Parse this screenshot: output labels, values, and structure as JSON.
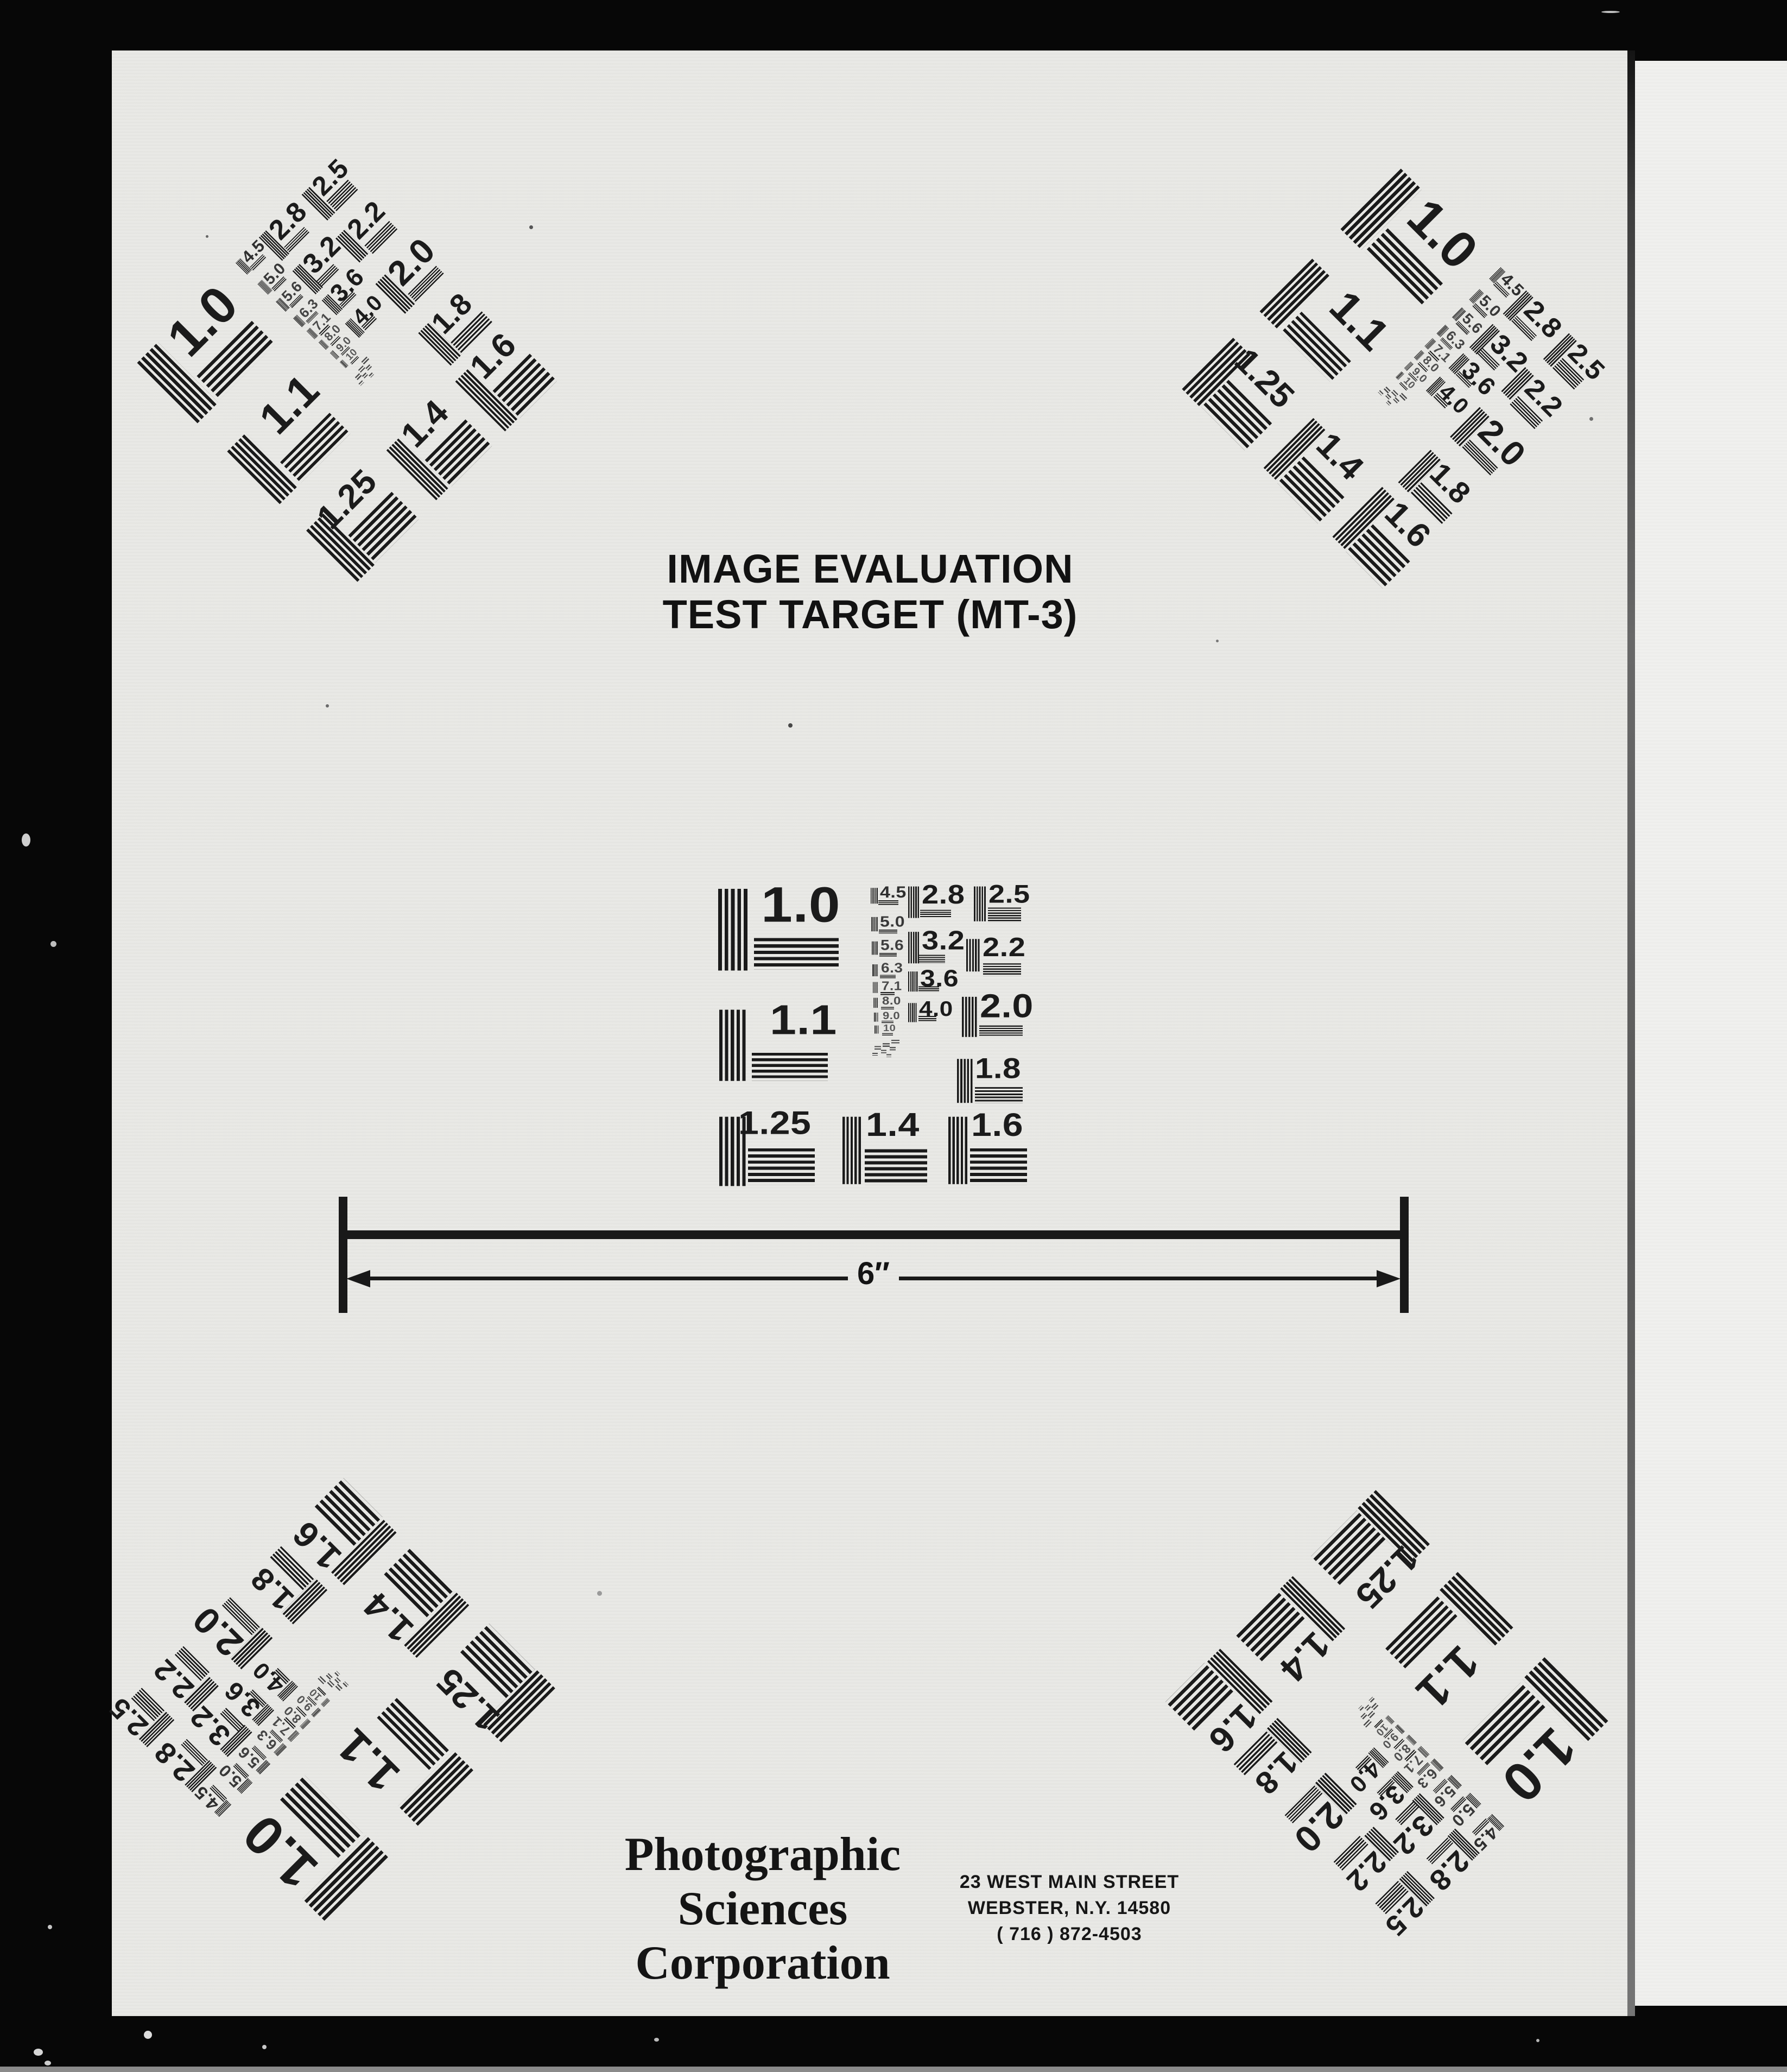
{
  "page": {
    "title_line1": "IMAGE EVALUATION",
    "title_line2": "TEST TARGET (MT-3)",
    "scale_label": "6″",
    "company_line1": "Photographic",
    "company_line2": "Sciences",
    "company_line3": "Corporation",
    "address_line1": "23 WEST MAIN STREET",
    "address_line2": "WEBSTER, N.Y. 14580",
    "address_line3": "( 716 ) 872-4503"
  },
  "colors": {
    "background": "#070707",
    "paper": "#e9e9e6",
    "paper_right": "#f0f0ee",
    "ink": "#1a1a1a"
  },
  "target_chart": {
    "big_labels": [
      "1.0",
      "1.1",
      "1.25"
    ],
    "bottom_labels": [
      "1.4",
      "1.6"
    ],
    "mid_labels": [
      "2.8",
      "3.2",
      "3.6",
      "4.0"
    ],
    "right_labels": [
      "2.5",
      "2.2",
      "2.0",
      "1.8"
    ],
    "tiny_labels": [
      "4.5",
      "5.0",
      "5.6",
      "6.3",
      "7.1",
      "8.0",
      "9.0",
      "10"
    ]
  }
}
